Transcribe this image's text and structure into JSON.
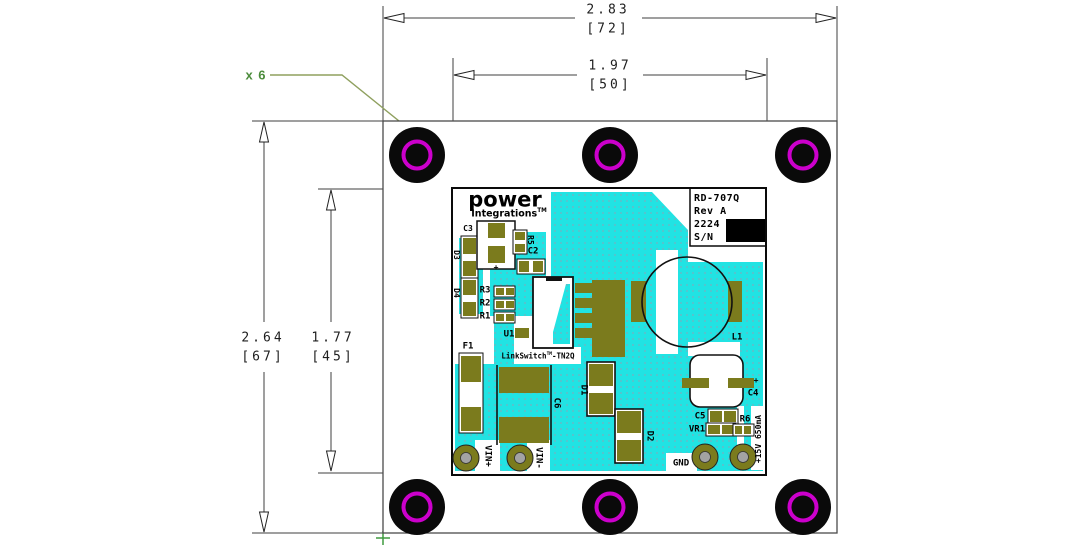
{
  "colors": {
    "copper_pour": "#21E3E3",
    "pad_olive": "#7B7B1D",
    "hole_ring_magenta": "#CC00CC",
    "callout_green": "#4C8C3C",
    "leader_green": "#8FA05F"
  },
  "dimensions": {
    "overall_width": {
      "inches": "2.83",
      "mm": "[72]"
    },
    "module_width": {
      "inches": "1.97",
      "mm": "[50]"
    },
    "overall_height": {
      "inches": "2.64",
      "mm": "[67]"
    },
    "module_height": {
      "inches": "1.77",
      "mm": "[45]"
    }
  },
  "callout": {
    "hole_count": "x 6"
  },
  "pcb": {
    "logo": {
      "word": "power",
      "sub": "Integrations",
      "tm": "TM"
    },
    "title_block": {
      "model": "RD-707Q",
      "rev": "Rev A",
      "date_code": "2224",
      "serial": "S/N"
    },
    "chip": {
      "name": "LinkSwitch",
      "tm": "TM",
      "suffix": "-TN2Q"
    },
    "refdes": {
      "c3": "C3",
      "d3": "D3",
      "d4": "D4",
      "r5": "R5",
      "c2": "C2",
      "r3": "R3",
      "r2": "R2",
      "r1": "R1",
      "u1": "U1",
      "f1": "F1",
      "c6": "C6",
      "d1": "D1",
      "d2": "D2",
      "l1": "L1",
      "c4": "C4",
      "c5": "C5",
      "vr1": "VR1",
      "r6": "R6"
    },
    "terminals": {
      "vin_plus": "VIN+",
      "vin_minus": "VIN-",
      "gnd": "GND",
      "output": "+15V 650mA"
    },
    "marks": {
      "cap_polarity": "+",
      "c4_polarity": "+"
    }
  }
}
